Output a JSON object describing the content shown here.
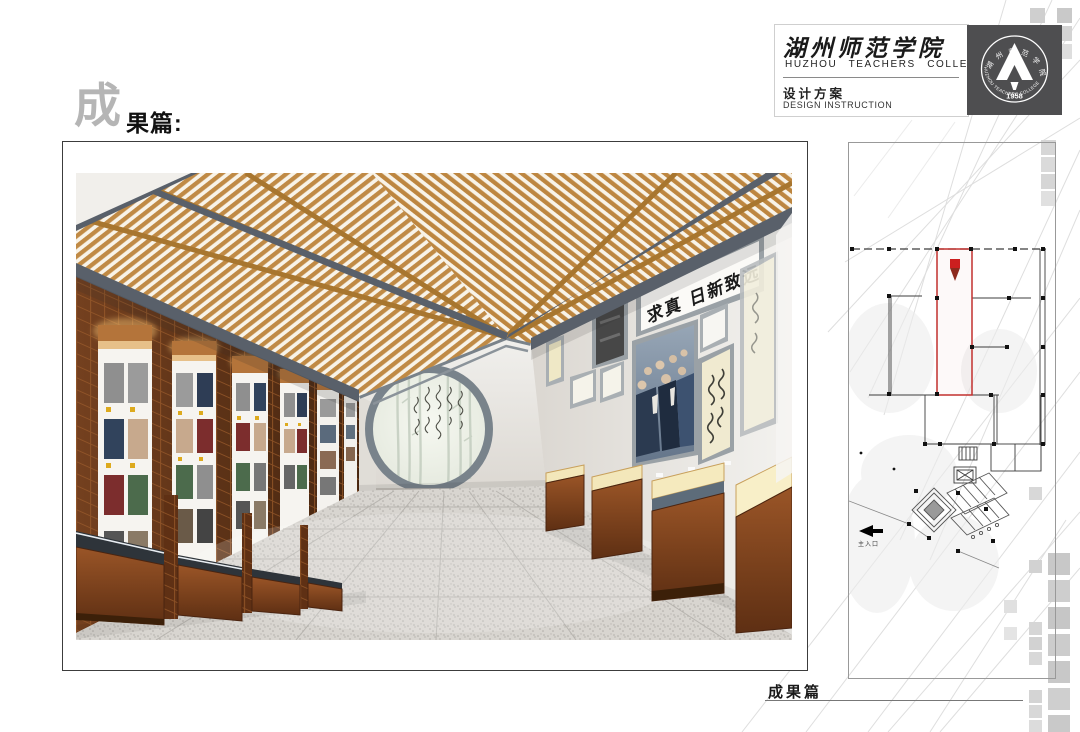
{
  "title": {
    "big_char": "成",
    "rest": "果篇:"
  },
  "header": {
    "college_cn": "湖州师范学院",
    "college_en": "HUZHOU TEACHERS COLLEGE",
    "subtitle_cn": "设计方案",
    "subtitle_en": "DESIGN INSTRUCTION"
  },
  "seal": {
    "ring_cn": "湖 州 师 范 学 院",
    "ring_en": "HUZHOU TEACHERS COLLEGE",
    "year": "1958"
  },
  "main_view": {
    "plaque_calligraphy": "求真 日新致远"
  },
  "floor_plan": {
    "entrance_label": "主入口",
    "highlight_color": "#c2302e"
  },
  "footer": {
    "section_label": "成果篇"
  },
  "colors": {
    "accent_red": "#c2302e",
    "wood": "#c08a45",
    "beam_gray": "#59606a",
    "case_brown": "#8a4a22"
  }
}
